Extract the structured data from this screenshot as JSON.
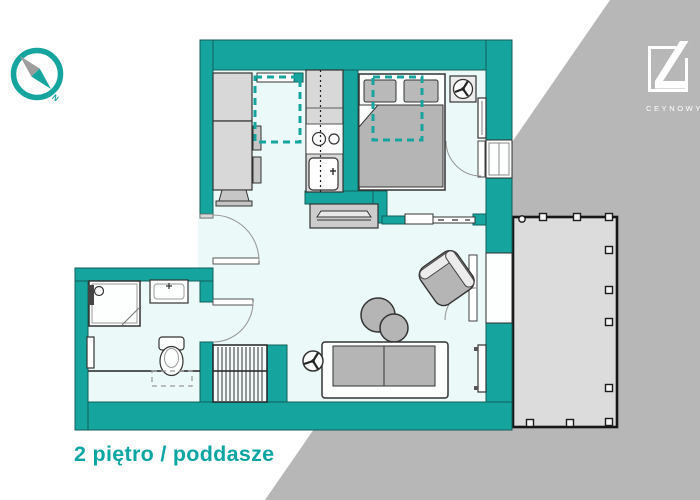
{
  "title": {
    "text": "2 piętro / poddasze",
    "color": "#0ba5a2"
  },
  "brand": {
    "name": "CEYNOWY",
    "color": "#ffffff"
  },
  "compass": {
    "north_label": "N"
  },
  "palette": {
    "wall_teal": "#15a49e",
    "floor_light": "#ebf9f8",
    "furniture_gray": "#b5b5b5",
    "cabinet_gray": "#d8d8d8",
    "background_gray": "#b7b7b7",
    "terrace_gray": "#dcdcdc",
    "outline_dark": "#2e2e2e",
    "logo_white": "#ffffff"
  },
  "icons": {
    "compass": "compass-circle with two-tone NW-SE needle",
    "ceiling_fan": "circle with three dark blades",
    "shower_head": "wall panel with round head",
    "roof_window": "teal dashed rectangle",
    "staircase": "hatched rectangle with vertical treads"
  },
  "plan": {
    "features": [
      "kitchen: tall cabinets, counter with cooktop and sink, roof window",
      "bedroom: double bed with pillows and duvet, roof window, fan, radiator, window door",
      "living room: sofa, rotated armchair, two round coffee tables, TV sideboard, ceiling fan, radiator, sliding door, double balcony doors",
      "bathroom: shower, washbasin, toilet, towel radiator, knee-wall line",
      "staircase with hatching",
      "terrace with railing posts"
    ]
  }
}
